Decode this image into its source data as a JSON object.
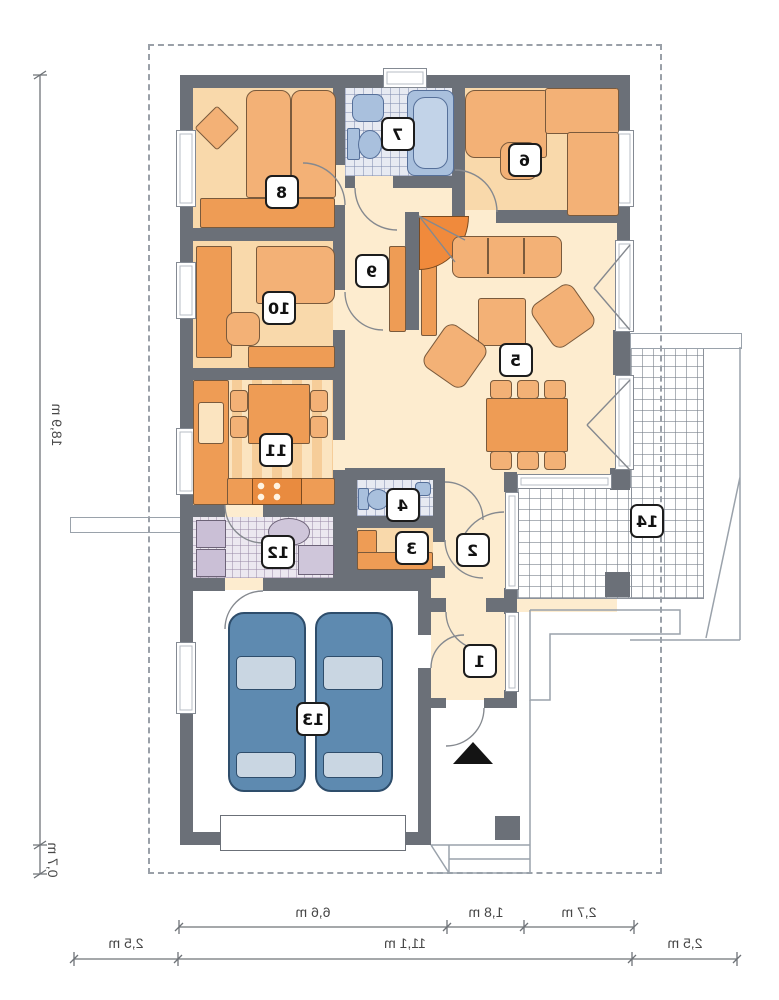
{
  "type": "floor-plan",
  "orientation": "mirrored",
  "rooms": [
    {
      "num": "1"
    },
    {
      "num": "2"
    },
    {
      "num": "3"
    },
    {
      "num": "4"
    },
    {
      "num": "5"
    },
    {
      "num": "6"
    },
    {
      "num": "7"
    },
    {
      "num": "8"
    },
    {
      "num": "9"
    },
    {
      "num": "10"
    },
    {
      "num": "11"
    },
    {
      "num": "12"
    },
    {
      "num": "13"
    },
    {
      "num": "14"
    }
  ],
  "dimensions": {
    "left_total": "18,9 m",
    "left_offset": "0,7 m",
    "bottom_upper": [
      "6,6 m",
      "1,8 m",
      "2,7 m"
    ],
    "bottom_lower": [
      "2,5 m",
      "11,1 m",
      "2,5 m"
    ]
  },
  "colors": {
    "wall": "#6b7078",
    "floor_cream": "#fdeccf",
    "floor_peach": "#f9d9ab",
    "accent_orange": "#ee9c55",
    "tile_blue": "#e7eaf2",
    "tile_lavender": "#ece8f0",
    "fixture_blue": "#a9c0dd",
    "car_blue": "#5e8ab0",
    "terrace_line": "#8c929b"
  }
}
